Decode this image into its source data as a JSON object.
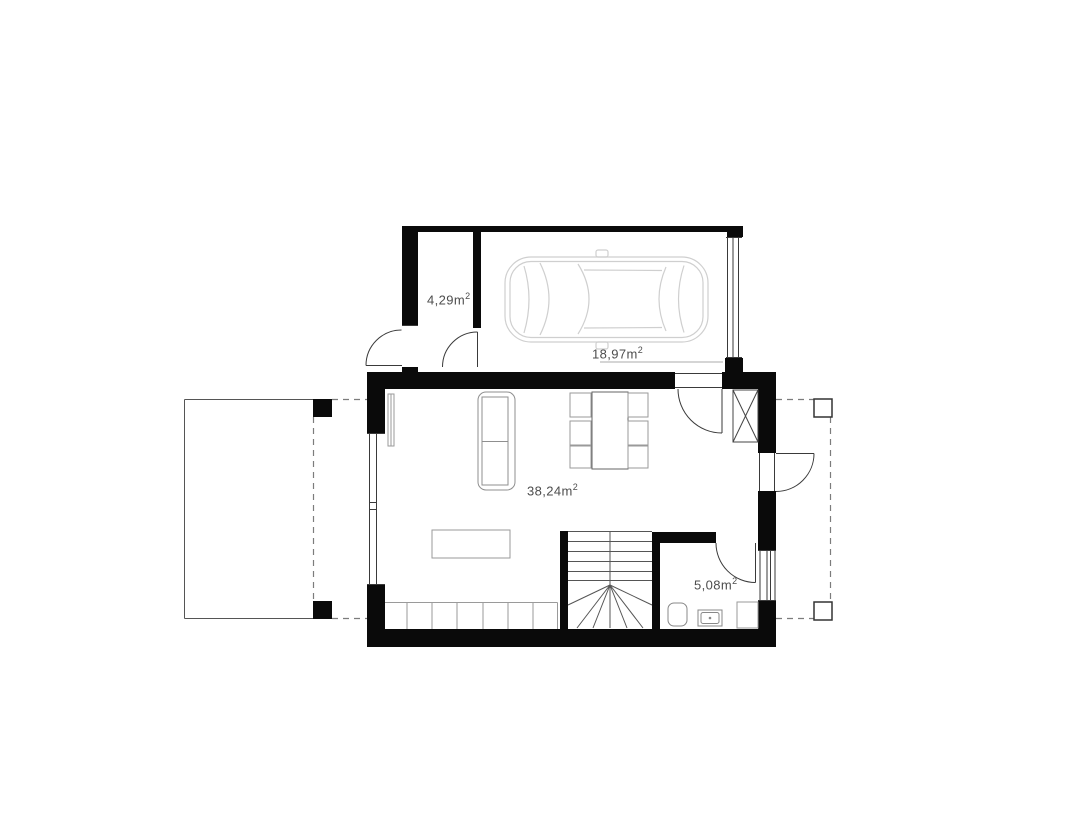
{
  "drawing": {
    "kind": "architectural floor plan, ground floor, top view"
  },
  "labels": {
    "vestibule": {
      "value": "4,29m",
      "sup": "2"
    },
    "garage": {
      "value": "18,97m",
      "sup": "2"
    },
    "living": {
      "value": "38,24m",
      "sup": "2"
    },
    "bathroom": {
      "value": "5,08m",
      "sup": "2"
    }
  },
  "colors": {
    "background": "#ffffff",
    "wall": "#0a0a0a",
    "line": "#3a3a3a",
    "furniture": "#8f8f8f",
    "car_outline": "#cfcfcf",
    "dashed": "#7c7c7c",
    "label_text": "#4d4d4d"
  }
}
